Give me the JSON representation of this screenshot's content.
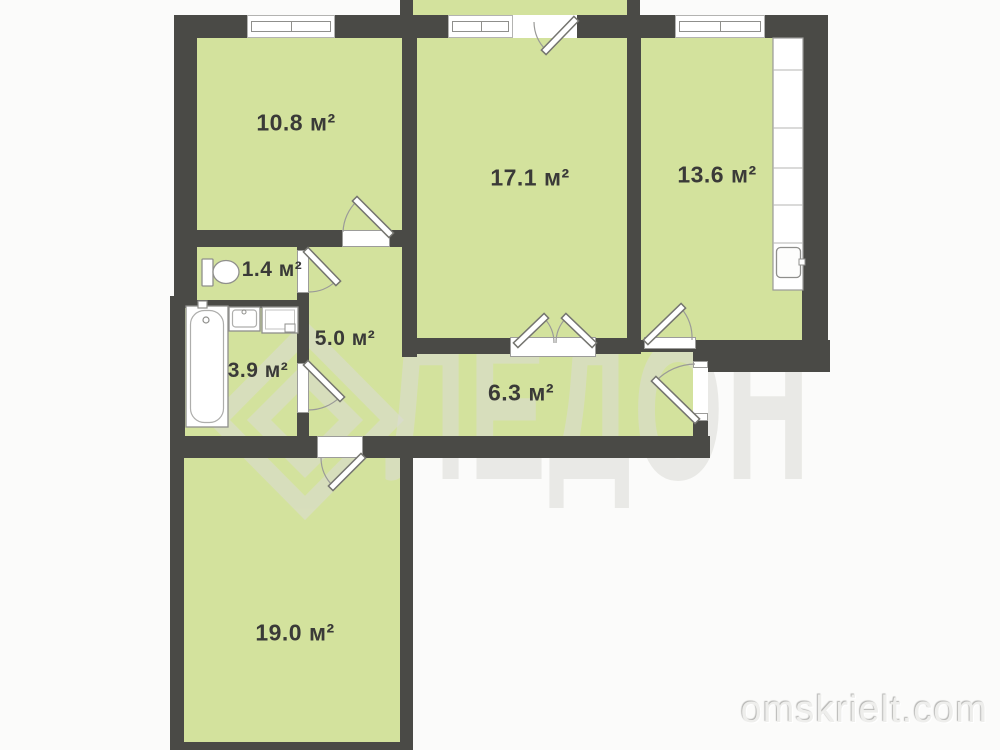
{
  "plan": {
    "type": "apartment-floor-plan",
    "unit_suffix": "м²"
  },
  "rooms": [
    {
      "id": "room-10-8",
      "label": "10.8 м²",
      "area": 10.8
    },
    {
      "id": "room-17-1",
      "label": "17.1 м²",
      "area": 17.1
    },
    {
      "id": "room-13-6",
      "label": "13.6 м²",
      "area": 13.6
    },
    {
      "id": "room-1-4",
      "label": "1.4 м²",
      "area": 1.4
    },
    {
      "id": "room-5-0",
      "label": "5.0 м²",
      "area": 5.0
    },
    {
      "id": "room-3-9",
      "label": "3.9 м²",
      "area": 3.9
    },
    {
      "id": "room-6-3",
      "label": "6.3 м²",
      "area": 6.3
    },
    {
      "id": "room-19-0",
      "label": "19.0 м²",
      "area": 19.0
    }
  ],
  "fixtures": [
    "toilet",
    "bathtub",
    "bathroom-sink",
    "washing-machine",
    "kitchen-counter",
    "kitchen-sink"
  ],
  "watermark": {
    "logo_text": "ЛЕДОН",
    "site": "omskrielt.com"
  },
  "colors": {
    "room_fill": "#d3e29d",
    "wall": "#4a4a46",
    "sill_border": "#9c9c9a",
    "frame": "#8f8f8c",
    "label_text": "#3a3a38",
    "watermark": "#dcdcd6",
    "background": "#fbfbfa"
  }
}
